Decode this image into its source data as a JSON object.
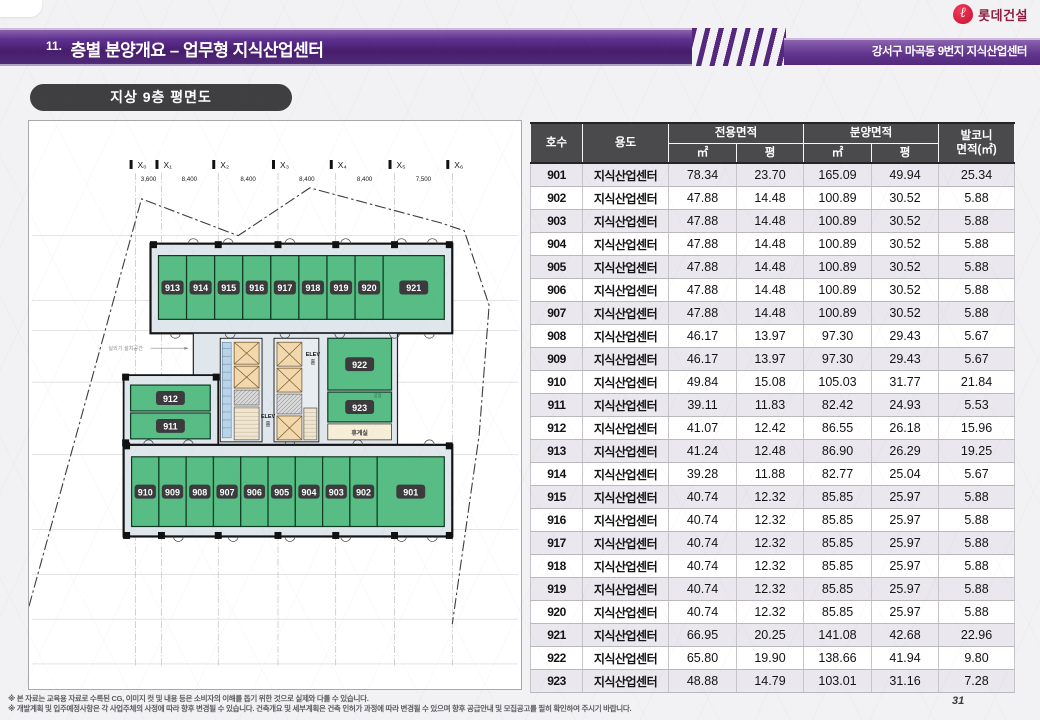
{
  "header": {
    "slide_no": "11.",
    "title": "층별 분양개요 – 업무형 지식산업센터",
    "subtitle": "강서구 마곡동 9번지 지식산업센터",
    "logo_text": "롯데건설",
    "logo_glyph": "ℓ"
  },
  "plan": {
    "badge_label": "지상 9층 평면도",
    "axis_labels": [
      "X₀",
      "X₁",
      "X₂",
      "X₃",
      "X₄",
      "X₅",
      "X₆"
    ],
    "dimensions": [
      "3,600",
      "8,400",
      "8,400",
      "8,400",
      "8,400",
      "7,500"
    ],
    "top_row_units": [
      "913",
      "914",
      "915",
      "916",
      "917",
      "918",
      "919",
      "920",
      "921"
    ],
    "bottom_row_units": [
      "910",
      "909",
      "908",
      "907",
      "906",
      "905",
      "904",
      "903",
      "902",
      "901"
    ],
    "left_units": [
      "912",
      "911"
    ],
    "right_units": [
      "922",
      "923"
    ],
    "rest_room_label": "휴게실",
    "factory_label": "공장",
    "elev_label": "ELEV",
    "hall_label": "홀",
    "outdoor_unit_label": "실외기 설치공간"
  },
  "table": {
    "headers": {
      "unit": "호수",
      "use": "용도",
      "exclusive": "전용면적",
      "sale": "분양면적",
      "balcony_line1": "발코니",
      "balcony_line2": "면적(㎡)",
      "sqm": "㎡",
      "pyeong": "평"
    },
    "rows": [
      {
        "no": "901",
        "use": "지식산업센터",
        "ex_m2": "78.34",
        "ex_py": "23.70",
        "sa_m2": "165.09",
        "sa_py": "49.94",
        "bal": "25.34"
      },
      {
        "no": "902",
        "use": "지식산업센터",
        "ex_m2": "47.88",
        "ex_py": "14.48",
        "sa_m2": "100.89",
        "sa_py": "30.52",
        "bal": "5.88"
      },
      {
        "no": "903",
        "use": "지식산업센터",
        "ex_m2": "47.88",
        "ex_py": "14.48",
        "sa_m2": "100.89",
        "sa_py": "30.52",
        "bal": "5.88"
      },
      {
        "no": "904",
        "use": "지식산업센터",
        "ex_m2": "47.88",
        "ex_py": "14.48",
        "sa_m2": "100.89",
        "sa_py": "30.52",
        "bal": "5.88"
      },
      {
        "no": "905",
        "use": "지식산업센터",
        "ex_m2": "47.88",
        "ex_py": "14.48",
        "sa_m2": "100.89",
        "sa_py": "30.52",
        "bal": "5.88"
      },
      {
        "no": "906",
        "use": "지식산업센터",
        "ex_m2": "47.88",
        "ex_py": "14.48",
        "sa_m2": "100.89",
        "sa_py": "30.52",
        "bal": "5.88"
      },
      {
        "no": "907",
        "use": "지식산업센터",
        "ex_m2": "47.88",
        "ex_py": "14.48",
        "sa_m2": "100.89",
        "sa_py": "30.52",
        "bal": "5.88"
      },
      {
        "no": "908",
        "use": "지식산업센터",
        "ex_m2": "46.17",
        "ex_py": "13.97",
        "sa_m2": "97.30",
        "sa_py": "29.43",
        "bal": "5.67"
      },
      {
        "no": "909",
        "use": "지식산업센터",
        "ex_m2": "46.17",
        "ex_py": "13.97",
        "sa_m2": "97.30",
        "sa_py": "29.43",
        "bal": "5.67"
      },
      {
        "no": "910",
        "use": "지식산업센터",
        "ex_m2": "49.84",
        "ex_py": "15.08",
        "sa_m2": "105.03",
        "sa_py": "31.77",
        "bal": "21.84"
      },
      {
        "no": "911",
        "use": "지식산업센터",
        "ex_m2": "39.11",
        "ex_py": "11.83",
        "sa_m2": "82.42",
        "sa_py": "24.93",
        "bal": "5.53"
      },
      {
        "no": "912",
        "use": "지식산업센터",
        "ex_m2": "41.07",
        "ex_py": "12.42",
        "sa_m2": "86.55",
        "sa_py": "26.18",
        "bal": "15.96"
      },
      {
        "no": "913",
        "use": "지식산업센터",
        "ex_m2": "41.24",
        "ex_py": "12.48",
        "sa_m2": "86.90",
        "sa_py": "26.29",
        "bal": "19.25"
      },
      {
        "no": "914",
        "use": "지식산업센터",
        "ex_m2": "39.28",
        "ex_py": "11.88",
        "sa_m2": "82.77",
        "sa_py": "25.04",
        "bal": "5.67"
      },
      {
        "no": "915",
        "use": "지식산업센터",
        "ex_m2": "40.74",
        "ex_py": "12.32",
        "sa_m2": "85.85",
        "sa_py": "25.97",
        "bal": "5.88"
      },
      {
        "no": "916",
        "use": "지식산업센터",
        "ex_m2": "40.74",
        "ex_py": "12.32",
        "sa_m2": "85.85",
        "sa_py": "25.97",
        "bal": "5.88"
      },
      {
        "no": "917",
        "use": "지식산업센터",
        "ex_m2": "40.74",
        "ex_py": "12.32",
        "sa_m2": "85.85",
        "sa_py": "25.97",
        "bal": "5.88"
      },
      {
        "no": "918",
        "use": "지식산업센터",
        "ex_m2": "40.74",
        "ex_py": "12.32",
        "sa_m2": "85.85",
        "sa_py": "25.97",
        "bal": "5.88"
      },
      {
        "no": "919",
        "use": "지식산업센터",
        "ex_m2": "40.74",
        "ex_py": "12.32",
        "sa_m2": "85.85",
        "sa_py": "25.97",
        "bal": "5.88"
      },
      {
        "no": "920",
        "use": "지식산업센터",
        "ex_m2": "40.74",
        "ex_py": "12.32",
        "sa_m2": "85.85",
        "sa_py": "25.97",
        "bal": "5.88"
      },
      {
        "no": "921",
        "use": "지식산업센터",
        "ex_m2": "66.95",
        "ex_py": "20.25",
        "sa_m2": "141.08",
        "sa_py": "42.68",
        "bal": "22.96"
      },
      {
        "no": "922",
        "use": "지식산업센터",
        "ex_m2": "65.80",
        "ex_py": "19.90",
        "sa_m2": "138.66",
        "sa_py": "41.94",
        "bal": "9.80"
      },
      {
        "no": "923",
        "use": "지식산업센터",
        "ex_m2": "48.88",
        "ex_py": "14.79",
        "sa_m2": "103.01",
        "sa_py": "31.16",
        "bal": "7.28"
      }
    ]
  },
  "footer": {
    "note1": "※ 본 자료는 교육용 자료로 수록된 CG, 이미지 컷 및 내용 등은 소비자의 이해를 돕기 위한 것으로 실제와 다를 수 있습니다.",
    "note2": "※ 개발계획 및 입주예정사항은 각 사업주체의 사정에 따라 향후 변경될 수 있습니다. 건축개요 및 세부계획은 건축 인허가 과정에 따라 변경될 수 있으며 향후 공급안내 및 모집공고를 필히 확인하여 주시기 바랍니다.",
    "page": "31"
  },
  "colors": {
    "accent_purple": "#5b2d86",
    "unit_green": "#57bd84",
    "badge_dark": "#3b3b3d",
    "logo_red": "#d5173c",
    "table_header_gray": "#4a4a4c",
    "row_alt": "#eae7ee",
    "rest_room_cream": "#f6eed6"
  }
}
